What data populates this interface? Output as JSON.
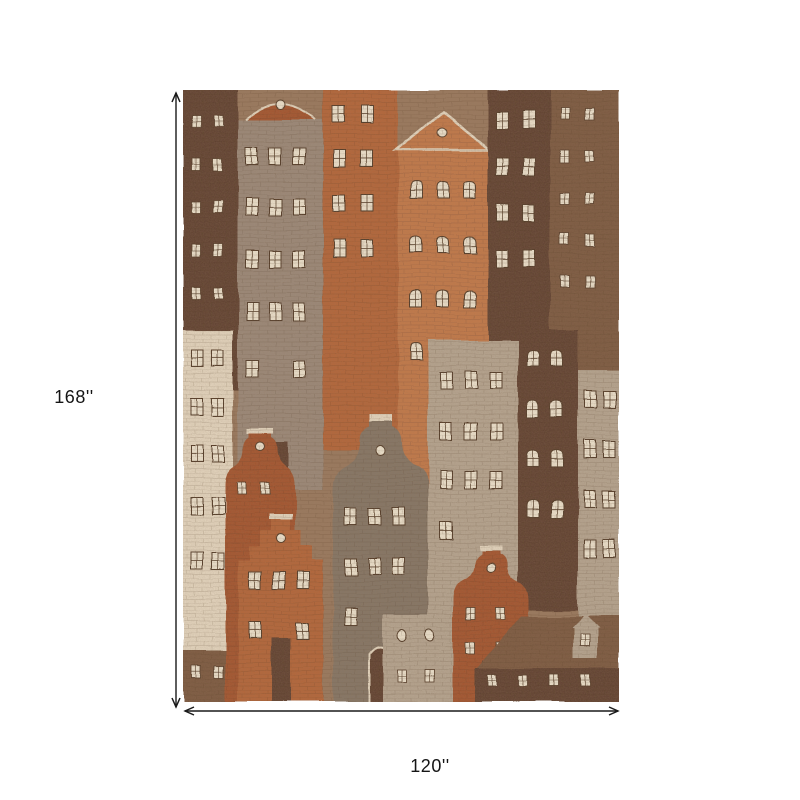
{
  "dimensions": {
    "height_label": "168''",
    "width_label": "120''"
  },
  "rug": {
    "description": "Area rug with watercolor pattern of Amsterdam-style canal houses in burnt orange, terracotta, brown, taupe and cream"
  },
  "colors": {
    "bg": "#ffffff",
    "line": "#1a1a1a",
    "text": "#151515",
    "rug_base": "#9a7a60",
    "orange": "#b4663a",
    "orange_light": "#c27a4c",
    "orange_deep": "#a4552d",
    "brown": "#7c5a42",
    "brown_dark": "#5f4130",
    "taupe": "#9b8a7a",
    "taupe_light": "#b6a692",
    "gray_house": "#857768",
    "cream": "#e4d6bf",
    "window": "#ede2cd",
    "frame": "#4e3826"
  }
}
